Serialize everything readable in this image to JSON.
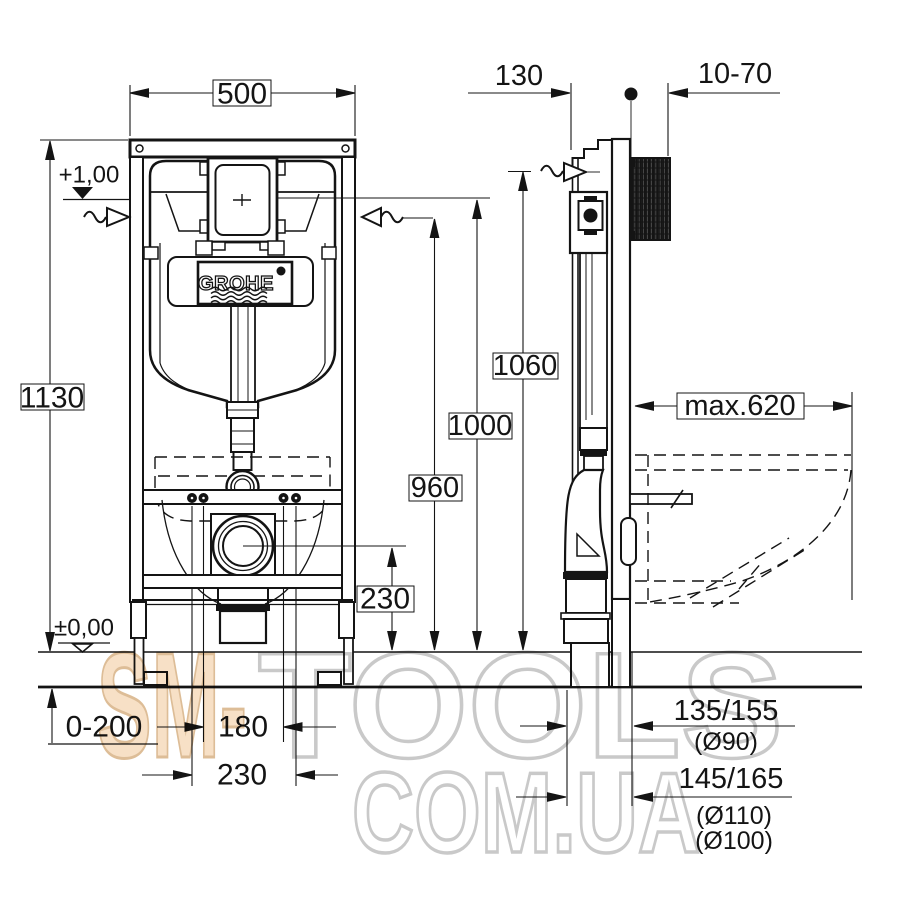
{
  "logo": {
    "brand": "GROHE"
  },
  "front_view": {
    "frame_width": "500",
    "frame_height": "1130",
    "level_top": "+1,00",
    "level_floor": "±0,00",
    "outlet_center_height": "230",
    "floor_buildup_range": "0-200",
    "fixing_spacing_inner": "180",
    "fixing_spacing_outer": "230"
  },
  "side_view": {
    "frame_depth": "130",
    "wall_adjust_range": "10-70",
    "height_supply": "1060",
    "height_plate_center": "1000",
    "height_connection": "960",
    "max_bowl_projection": "max.620",
    "outlet_offset_small": "135/155",
    "outlet_dia_small": "(Ø90)",
    "outlet_offset_large": "145/165",
    "outlet_dia_large": "(Ø110)",
    "outlet_dia_alt": "(Ø100)"
  },
  "watermark": {
    "word_sm": "SM-",
    "word_tools": "TOOLS",
    "word_domain": "COM.UA",
    "accent_fill": "#f7e0c6",
    "accent_stroke": "#ddbd97",
    "gray_stroke": "#c9c9c9"
  },
  "colors": {
    "line": "#141414",
    "background": "#ffffff"
  }
}
